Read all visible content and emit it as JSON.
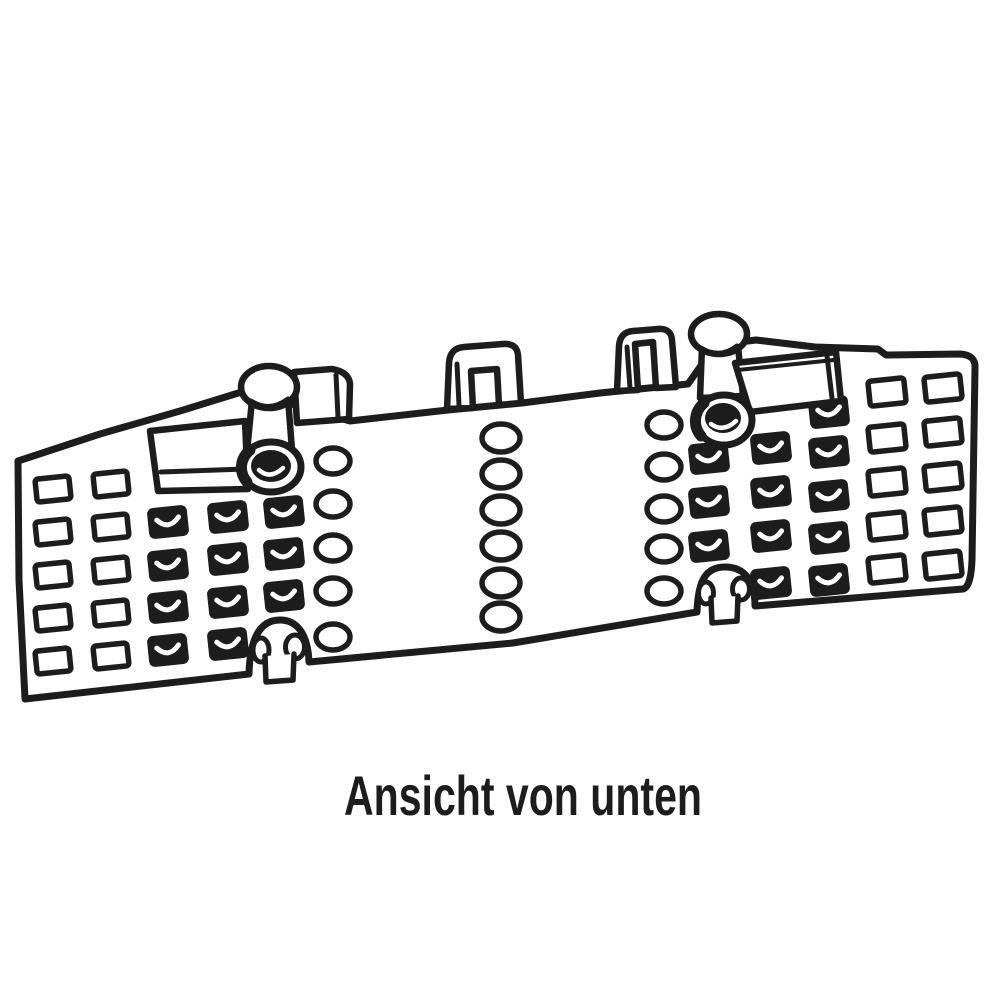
{
  "caption": {
    "text": "Ansicht von unten"
  },
  "colors": {
    "ink": "#1d1d1d",
    "paper": "#ffffff"
  },
  "diagram": {
    "type": "technical-illustration",
    "subject": "perforated mounting rail with two fastening knobs, viewed from below",
    "rect_angle": -6,
    "oval_columns": [
      {
        "cx": 333,
        "rx": 17,
        "ry": 13,
        "centers": [
          461,
          504,
          548,
          591,
          637
        ]
      },
      {
        "cx": 501,
        "rx": 19,
        "ry": 14,
        "centers": [
          438,
          474,
          510,
          546,
          583,
          617
        ]
      },
      {
        "cx": 664,
        "rx": 17,
        "ry": 13,
        "centers": [
          425,
          467,
          509,
          549,
          591
        ]
      }
    ],
    "open_rect_columns": [
      {
        "cx": 53,
        "w": 34,
        "h": 23,
        "rows": [
          489,
          532,
          575,
          618,
          661
        ]
      },
      {
        "cx": 111,
        "w": 34,
        "h": 23,
        "rows": [
          484,
          527,
          570,
          613,
          656
        ]
      },
      {
        "cx": 887,
        "w": 36,
        "h": 25,
        "rows": [
          392,
          438,
          482,
          526,
          569
        ]
      },
      {
        "cx": 943,
        "w": 36,
        "h": 25,
        "rows": [
          388,
          432,
          477,
          521,
          565
        ]
      }
    ],
    "filled_rect_columns": [
      {
        "cx": 168,
        "w": 36,
        "h": 27,
        "rows": [
          522,
          565,
          607,
          650
        ]
      },
      {
        "cx": 228,
        "w": 36,
        "h": 27,
        "rows": [
          517,
          559,
          602,
          644
        ]
      },
      {
        "cx": 284,
        "w": 36,
        "h": 27,
        "rows": [
          512,
          554,
          596
        ]
      },
      {
        "cx": 709,
        "w": 36,
        "h": 27,
        "rows": [
          458,
          502,
          546
        ]
      },
      {
        "cx": 771,
        "w": 36,
        "h": 27,
        "rows": [
          448,
          492,
          536,
          583
        ]
      },
      {
        "cx": 829,
        "w": 36,
        "h": 27,
        "rows": [
          412,
          452,
          496,
          538,
          580
        ]
      }
    ]
  }
}
